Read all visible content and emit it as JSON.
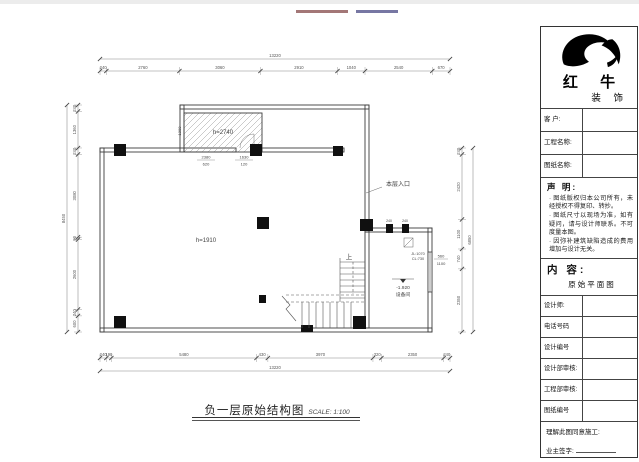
{
  "top_strip": {
    "fragments": [
      {
        "color": "#8c5555",
        "width": 52
      },
      {
        "color": "#55558c",
        "width": 42
      }
    ]
  },
  "sheet_title": {
    "text": "负一层原始结构图",
    "scale": "SCALE: 1:100"
  },
  "plan": {
    "labels": {
      "upper_room_height": "h=2740",
      "main_room_height": "h=1910",
      "entrance": "本层入口",
      "up": "上",
      "level_value": "-1.920",
      "level_room": "设备间",
      "window_mark_line1": "JL:1070",
      "window_mark_line2": "CL:730",
      "right_window_width": "560",
      "right_window_height": "1100",
      "hatch_dim1_top": "2380",
      "hatch_dim1_bottom": "620",
      "hatch_dim2_top": "1630",
      "hatch_dim2_bottom": "120",
      "hatch_side_dim": "1300",
      "stub_dim1": "240",
      "stub_dim2": "240"
    },
    "dims": {
      "top": {
        "total": "13220",
        "segments": [
          240,
          2760,
          3060,
          2910,
          1040,
          2540,
          670
        ]
      },
      "bottom": {
        "total": "13220",
        "segments": [
          240,
          190,
          5480,
          430,
          3970,
          320,
          2350,
          240
        ]
      },
      "left": {
        "total": "8450",
        "segments": [
          240,
          1360,
          240,
          3080,
          90,
          2600,
          240,
          600
        ]
      },
      "right": {
        "total": "6850",
        "segments": [
          240,
          2420,
          1100,
          740,
          2350
        ]
      }
    }
  },
  "panel": {
    "brand": {
      "name": "红 牛",
      "sub": "装 饰"
    },
    "fields_top": [
      {
        "label": "客  户:"
      },
      {
        "label": "工程名称:"
      },
      {
        "label": "图纸名称:"
      }
    ],
    "statement": {
      "heading": "声 明:",
      "items": [
        "图纸版权归本公司所有，未经授权不得复印、转抄。",
        "图纸尺寸以现场为准，如有疑问，请与设计师联系。不可度量本图。",
        "因弥补建筑缺陷造成的费用增加与设计无关。"
      ]
    },
    "content": {
      "heading": "内 容:",
      "value": "原始平面图"
    },
    "fields_form": [
      {
        "label": "设计师:"
      },
      {
        "label": "电话号码"
      },
      {
        "label": "设计编号"
      },
      {
        "label": "设计部审核:"
      },
      {
        "label": "工程部审核:"
      },
      {
        "label": "图纸编号"
      }
    ],
    "footer": {
      "line1": "理解此图同意施工:",
      "line2": "业主签字:"
    }
  }
}
